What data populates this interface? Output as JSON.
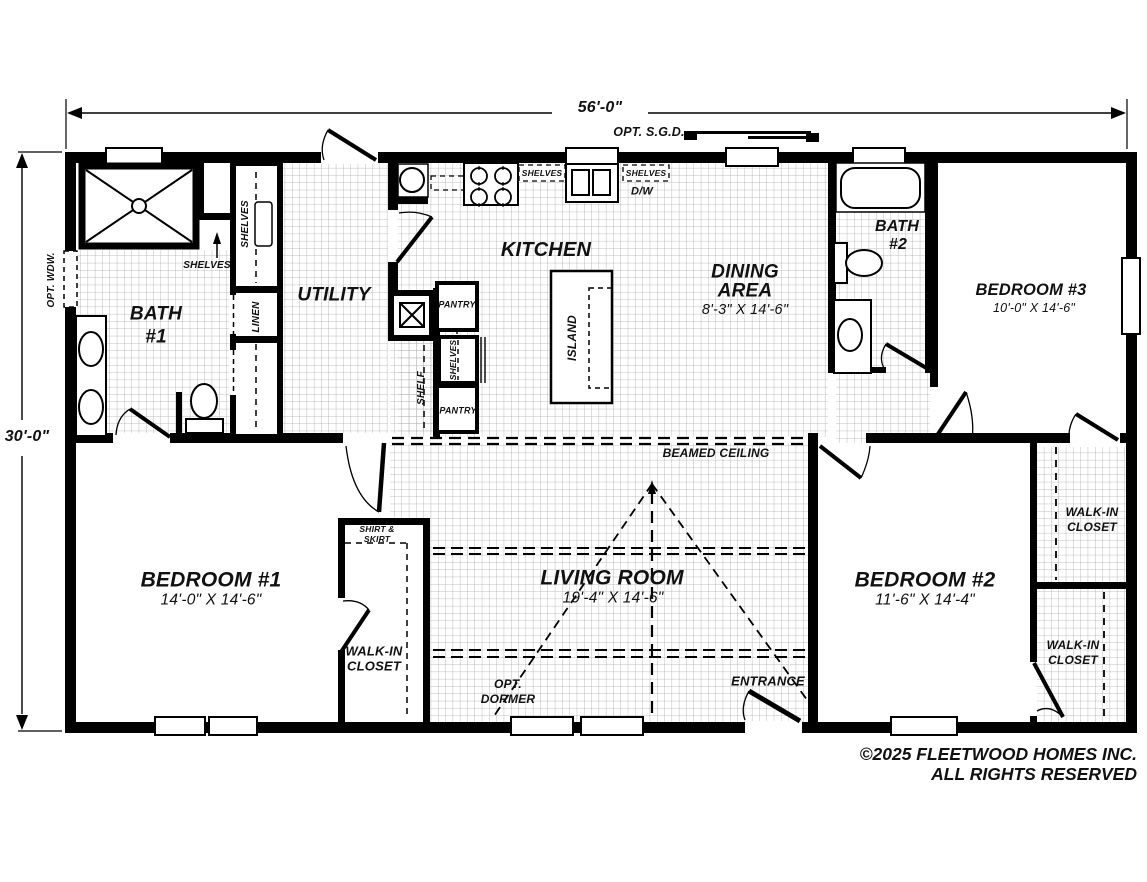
{
  "dimensions": {
    "width": "56'-0\"",
    "depth": "30'-0\""
  },
  "rooms": {
    "bath1": {
      "line1": "BATH",
      "line2": "#1"
    },
    "bath2": {
      "line1": "BATH",
      "line2": "#2"
    },
    "utility": {
      "name": "UTILITY"
    },
    "kitchen": {
      "name": "KITCHEN"
    },
    "dining": {
      "line1": "DINING",
      "line2": "AREA",
      "size": "8'-3\" X 14'-6\""
    },
    "living": {
      "name": "LIVING ROOM",
      "size": "19'-4\" X 14'-6\""
    },
    "bedroom1": {
      "name": "BEDROOM #1",
      "size": "14'-0\" X 14'-6\""
    },
    "bedroom2": {
      "name": "BEDROOM #2",
      "size": "11'-6\" X 14'-4\""
    },
    "bedroom3": {
      "name": "BEDROOM #3",
      "size": "10'-0\" X 14'-6\""
    },
    "closet_bedroom1": {
      "line1": "WALK-IN",
      "line2": "CLOSET"
    },
    "closet_top_right": {
      "line1": "WALK-IN",
      "line2": "CLOSET"
    },
    "closet_bottom_right": {
      "line1": "WALK-IN",
      "line2": "CLOSET"
    }
  },
  "features": {
    "opt_sgd": "OPT. S.G.D.",
    "opt_wdw": "OPT. WDW.",
    "beamed_ceiling": "BEAMED CEILING",
    "opt_dormer_line1": "OPT.",
    "opt_dormer_line2": "DORMER",
    "entrance": "ENTRANCE",
    "shirt_skirt_line1": "SHIRT &",
    "shirt_skirt_line2": "SKIRT",
    "shelves": "SHELVES",
    "linen": "LINEN",
    "pantry": "PANTRY",
    "shelf": "SHELF",
    "island": "ISLAND",
    "dishwasher": "D/W"
  },
  "footer": {
    "copyright_line1": "©2025 FLEETWOOD HOMES INC.",
    "copyright_line2": "ALL RIGHTS RESERVED"
  },
  "colors": {
    "wall": "#000000",
    "grid": "#aaaaaa",
    "text": "#111111"
  }
}
